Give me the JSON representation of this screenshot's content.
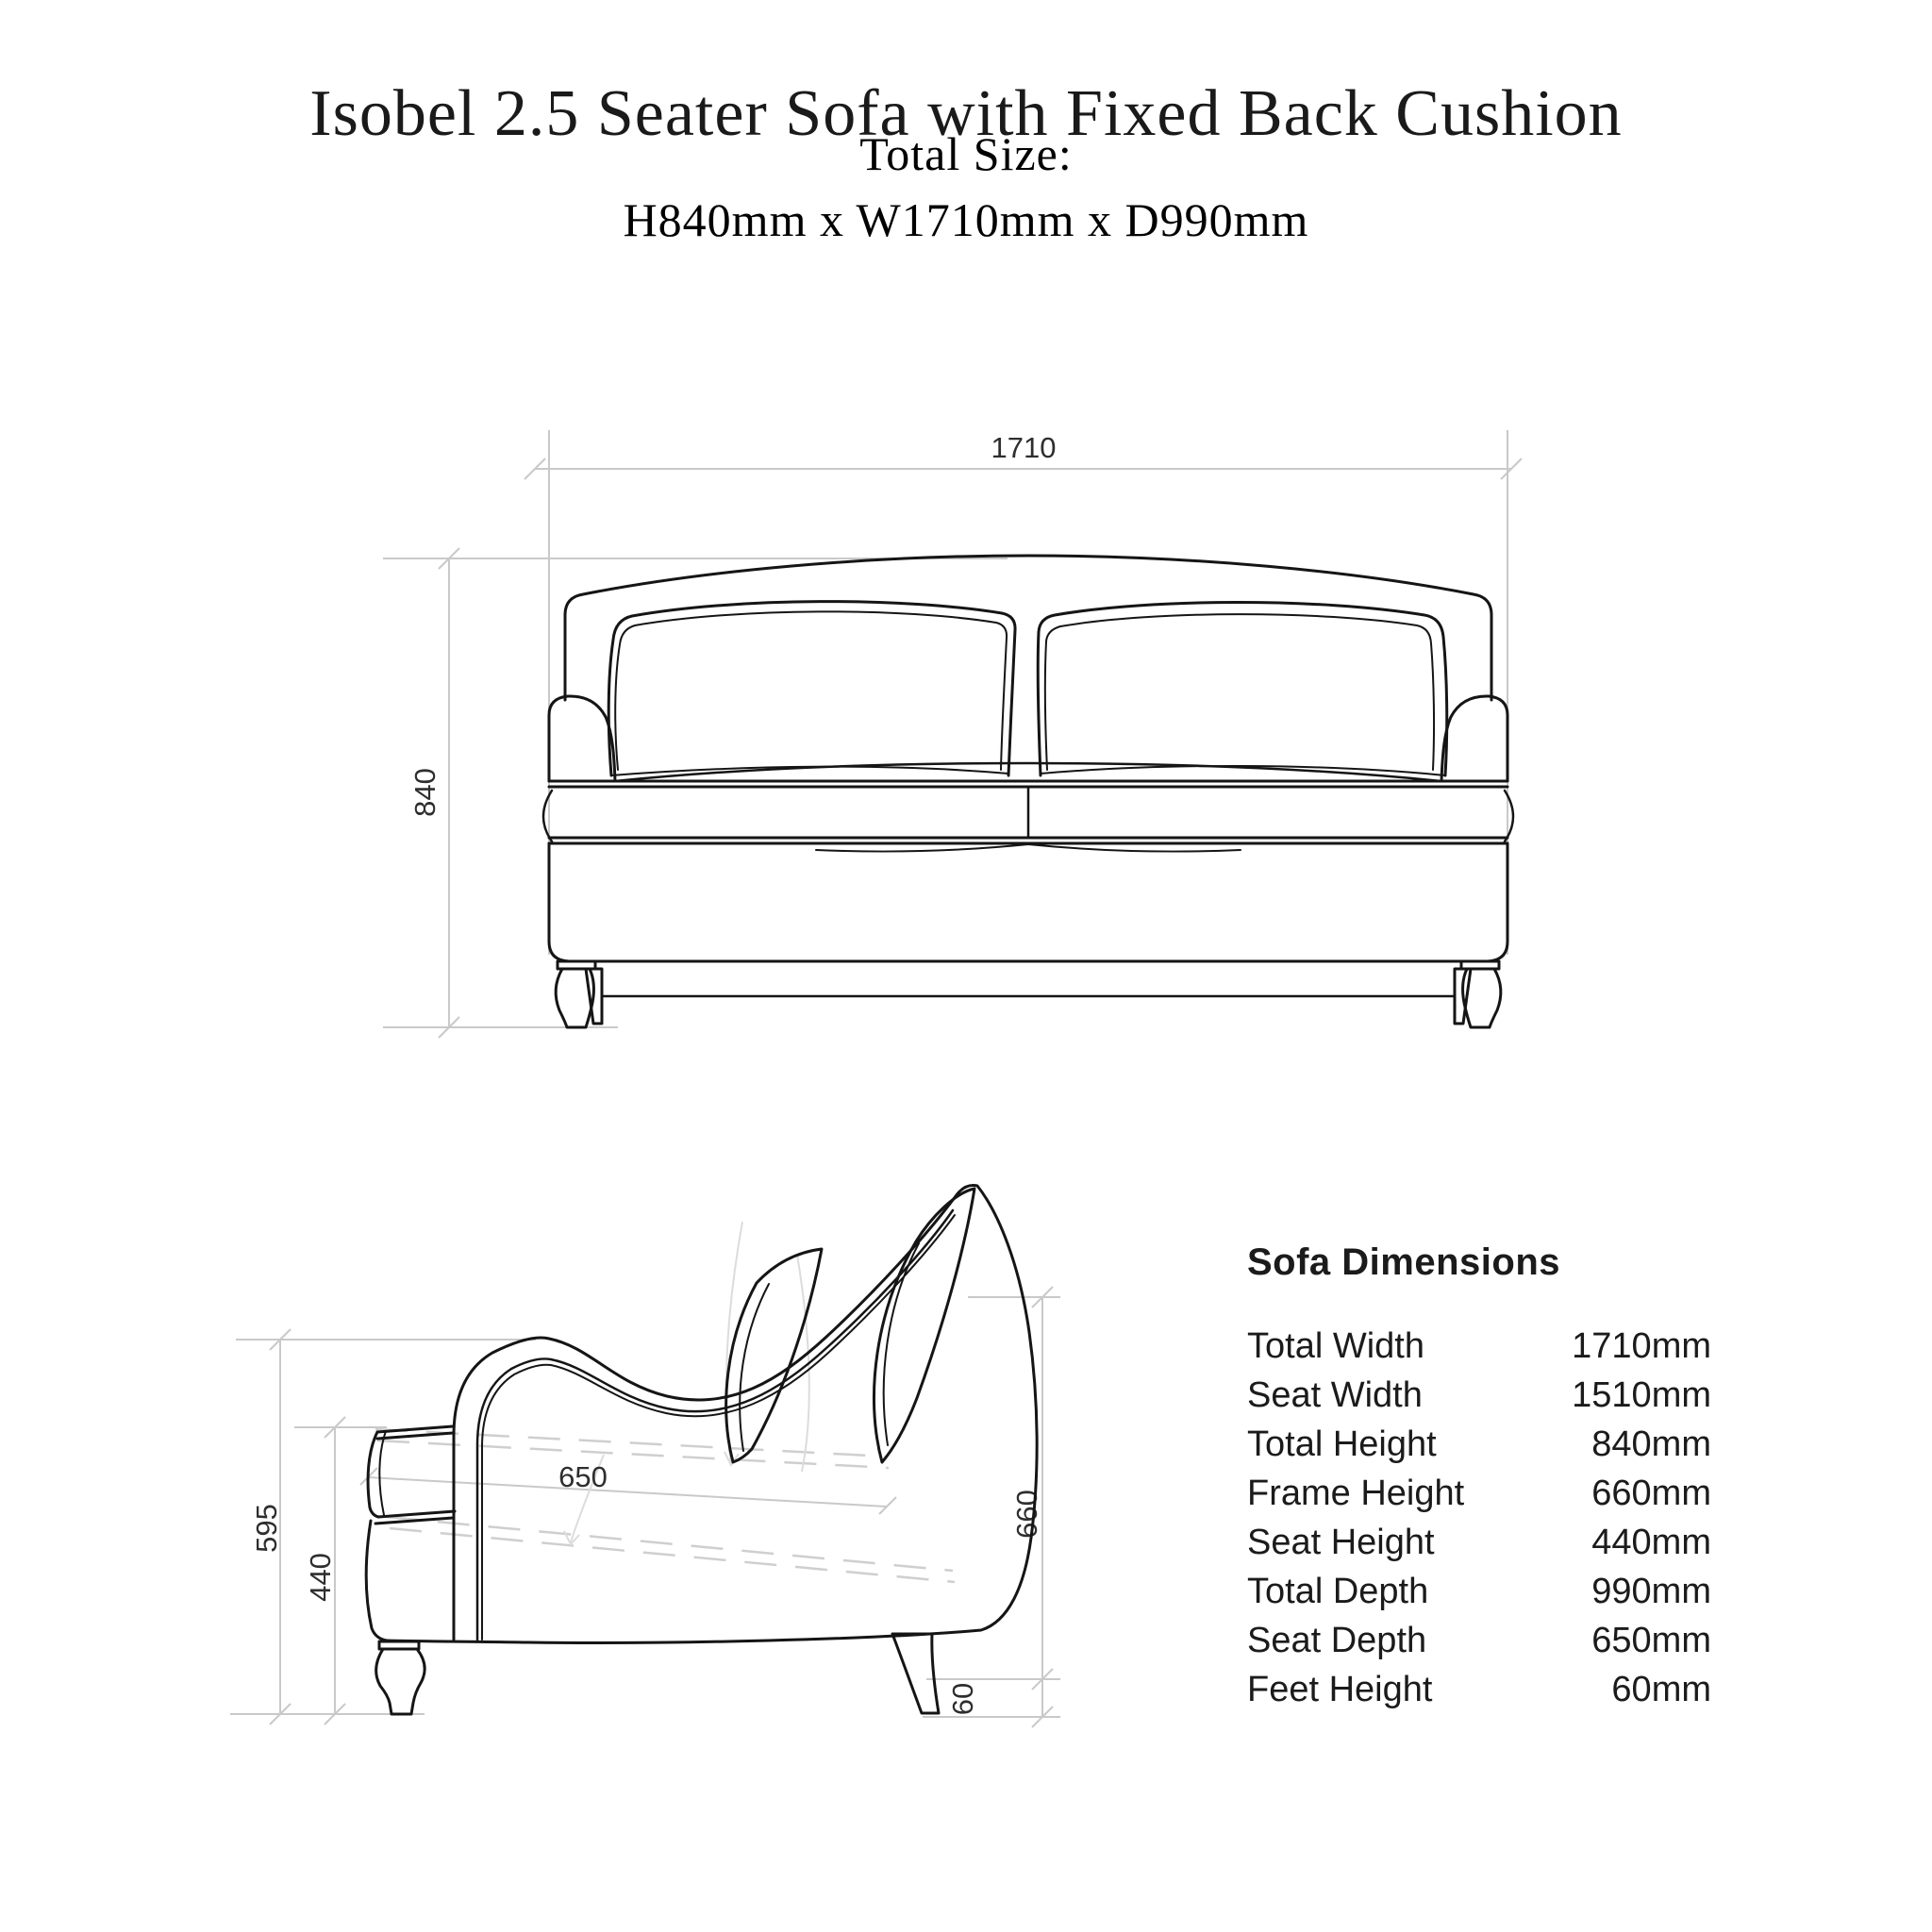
{
  "header": {
    "title": "Isobel 2.5 Seater Sofa with Fixed Back Cushion",
    "total_size_label": "Total Size:",
    "total_size_value": "H840mm x W1710mm x D990mm"
  },
  "front_view": {
    "width_dim": "1710",
    "height_dim": "840"
  },
  "side_view": {
    "overall_height_dim": "595",
    "seat_height_dim": "440",
    "seat_depth_dim": "650",
    "frame_height_dim": "660",
    "feet_height_dim": "60"
  },
  "dimensions_table": {
    "heading": "Sofa Dimensions",
    "rows": [
      {
        "label": "Total Width",
        "value": "1710mm"
      },
      {
        "label": "Seat Width",
        "value": "1510mm"
      },
      {
        "label": "Total Height",
        "value": "840mm"
      },
      {
        "label": "Frame Height",
        "value": "660mm"
      },
      {
        "label": "Seat Height",
        "value": "440mm"
      },
      {
        "label": "Total Depth",
        "value": "990mm"
      },
      {
        "label": "Seat Depth",
        "value": "650mm"
      },
      {
        "label": "Feet Height",
        "value": "60mm"
      }
    ]
  },
  "colors": {
    "background": "#ffffff",
    "drawing_ink": "#151515",
    "dimension_line": "#c9c9c9",
    "dimension_text": "#2e2e2e",
    "text": "#1b1b1b"
  }
}
